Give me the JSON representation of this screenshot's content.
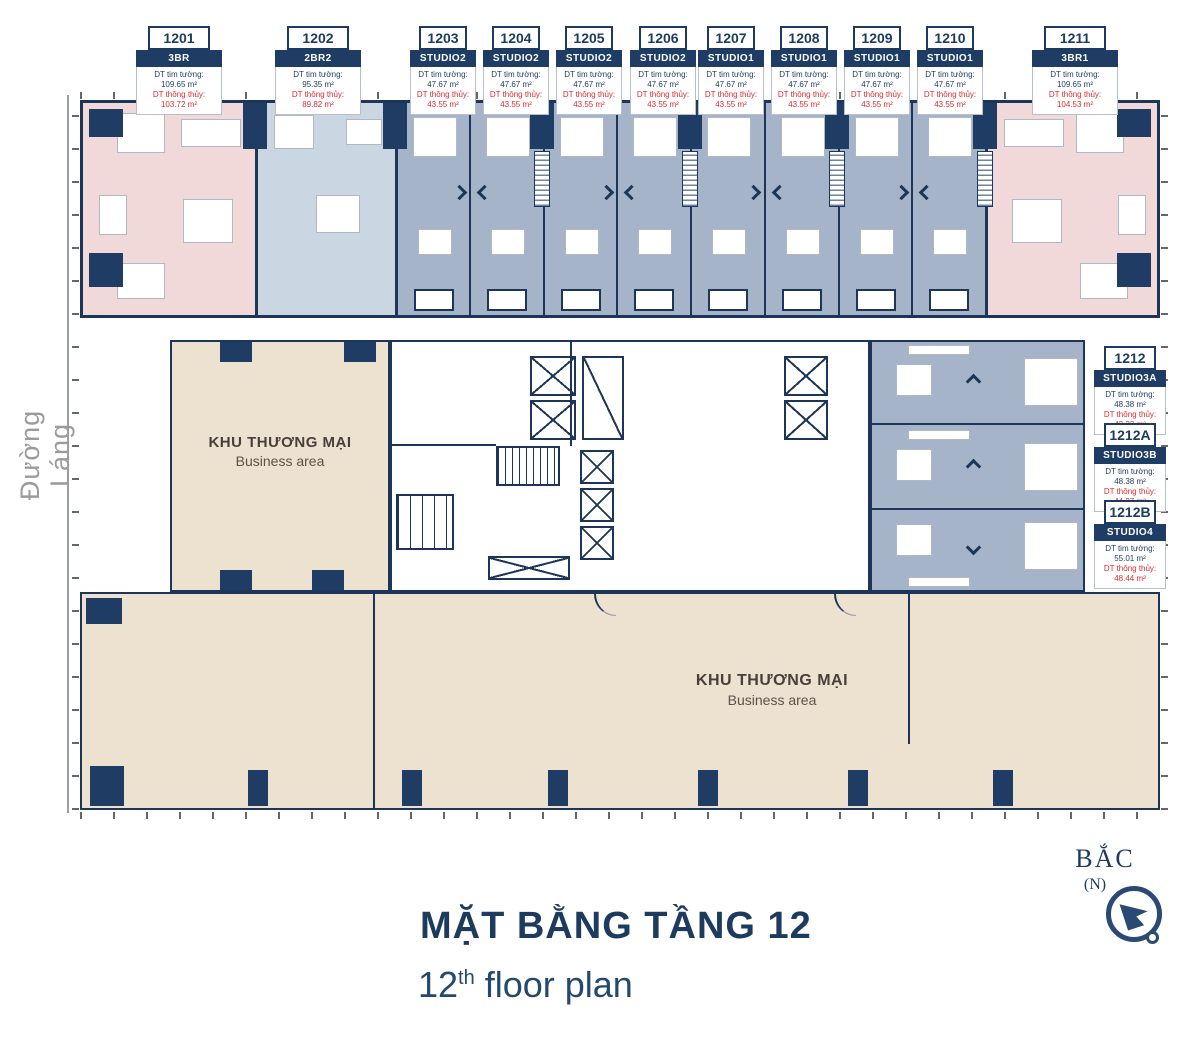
{
  "page": {
    "street_label": "Đường Láng",
    "compass_label": "BẮC",
    "compass_sub": "(N)",
    "title_vi": "MẶT BẰNG TẦNG 12",
    "title_en": {
      "num": "12",
      "sup": "th",
      "rest": " floor plan"
    }
  },
  "labels": {
    "area_wall": "DT tim tường:",
    "area_clear": "DT thông thủy:"
  },
  "business_area": {
    "vi": "KHU THƯƠNG MẠI",
    "en": "Business area"
  },
  "colors": {
    "navy": "#1E3C64",
    "wall": "#1C3558",
    "red": "#E02B2F",
    "pink": "#F1D9DA",
    "unit_blue": "#CBD6E3",
    "studio_blue": "#A6B4C9",
    "beige": "#EDE1D0",
    "street_gray": "#9B9B9B"
  },
  "units_top": [
    {
      "number": "1201",
      "type": "3BR",
      "wall_area": "109.65 m²",
      "clear_area": "103.72 m²"
    },
    {
      "number": "1202",
      "type": "2BR2",
      "wall_area": "95.35 m²",
      "clear_area": "89.82 m²"
    },
    {
      "number": "1203",
      "type": "STUDIO2",
      "wall_area": "47.67 m²",
      "clear_area": "43.55 m²"
    },
    {
      "number": "1204",
      "type": "STUDIO2",
      "wall_area": "47.67 m²",
      "clear_area": "43.55 m²"
    },
    {
      "number": "1205",
      "type": "STUDIO2",
      "wall_area": "47.67 m²",
      "clear_area": "43.55 m²"
    },
    {
      "number": "1206",
      "type": "STUDIO2",
      "wall_area": "47.67 m²",
      "clear_area": "43.55 m²"
    },
    {
      "number": "1207",
      "type": "STUDIO1",
      "wall_area": "47.67 m²",
      "clear_area": "43.55 m²"
    },
    {
      "number": "1208",
      "type": "STUDIO1",
      "wall_area": "47.67 m²",
      "clear_area": "43.55 m²"
    },
    {
      "number": "1209",
      "type": "STUDIO1",
      "wall_area": "47.67 m²",
      "clear_area": "43.55 m²"
    },
    {
      "number": "1210",
      "type": "STUDIO1",
      "wall_area": "47.67 m²",
      "clear_area": "43.55 m²"
    },
    {
      "number": "1211",
      "type": "3BR1",
      "wall_area": "109.65 m²",
      "clear_area": "104.53 m²"
    }
  ],
  "units_right": [
    {
      "number": "1212",
      "type": "STUDIO3A",
      "wall_area": "48.38 m²",
      "clear_area": "42.23 m²"
    },
    {
      "number": "1212A",
      "type": "STUDIO3B",
      "wall_area": "48.38 m²",
      "clear_area": "44.27 m²"
    },
    {
      "number": "1212B",
      "type": "STUDIO4",
      "wall_area": "55.01 m²",
      "clear_area": "48.44 m²"
    }
  ]
}
